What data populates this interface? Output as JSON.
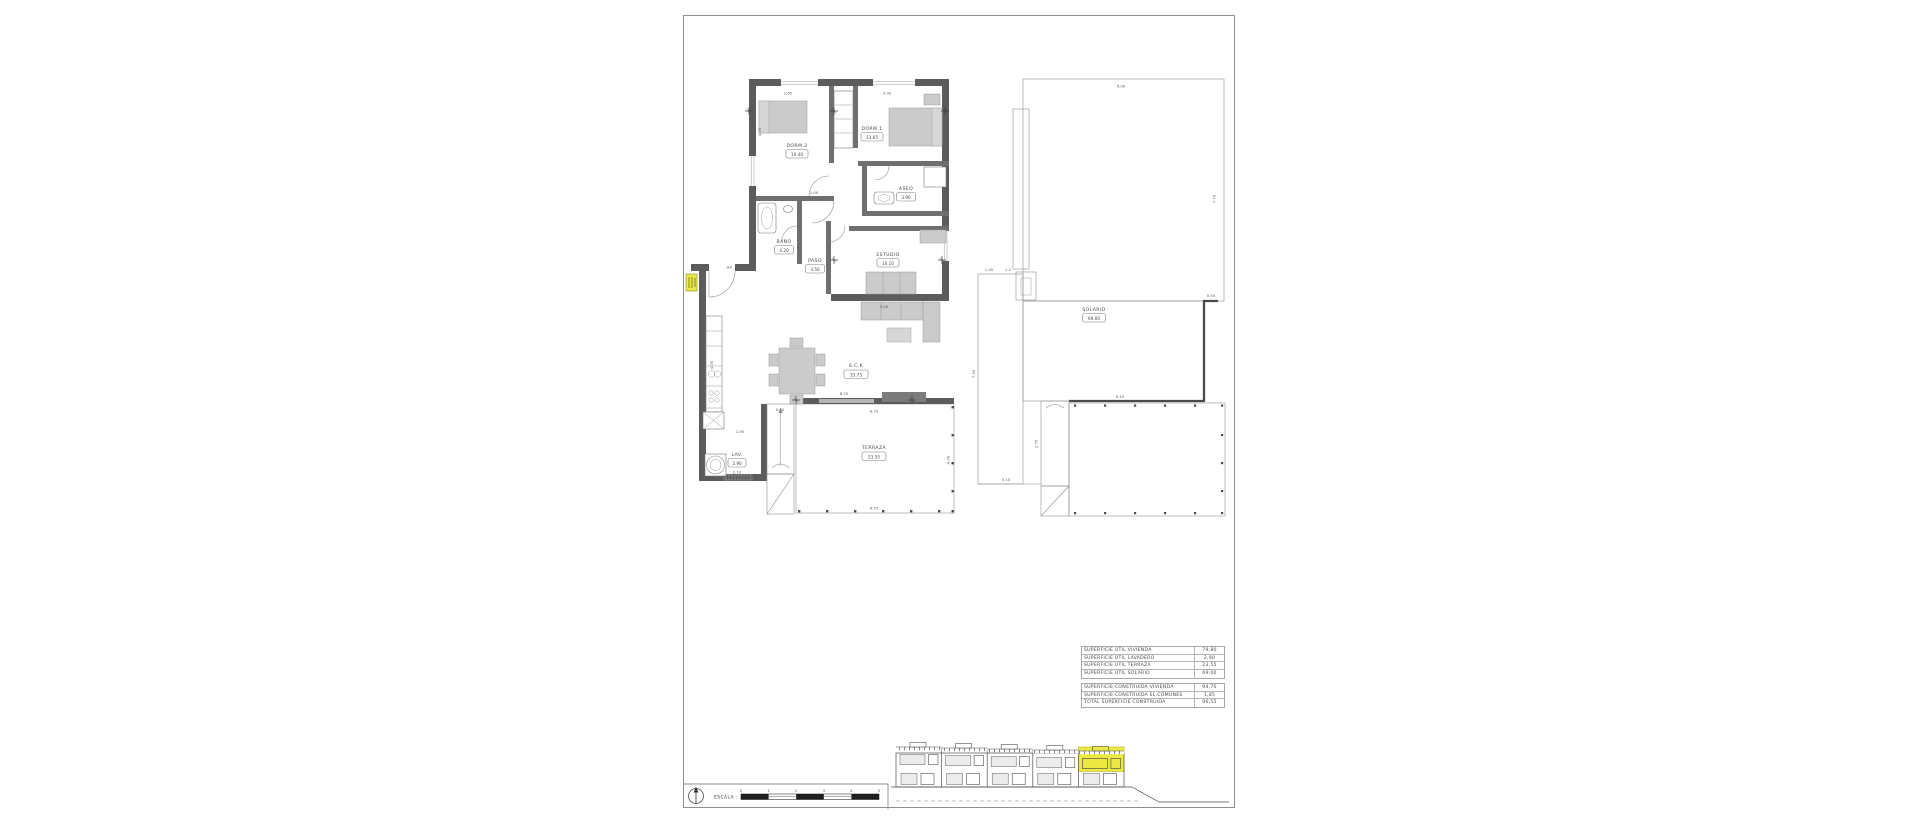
{
  "floor_plan": {
    "rooms": {
      "dorm2": {
        "label": "DORM.2",
        "area": "10.40"
      },
      "dorm1": {
        "label": "DORM.1",
        "area": "13.65"
      },
      "aseo": {
        "label": "ASEO",
        "area": "3.90"
      },
      "bano": {
        "label": "BAÑO",
        "area": "4.20"
      },
      "paso": {
        "label": "PASO",
        "area": "3.50"
      },
      "estudio": {
        "label": "ESTUDIO",
        "area": "10.10"
      },
      "sck": {
        "label": "S.C.K",
        "area": "33.75"
      },
      "lav": {
        "label": "LAV.",
        "area": "2.90"
      },
      "terraza": {
        "label": "TERRAZA",
        "area": "23.55"
      }
    },
    "dims": {
      "top_left": "2.65",
      "top_right": "3.00",
      "dorm2_depth": "4.05",
      "entry_door": ".80",
      "hall_width": "1.00",
      "kitchen_run": "4.05",
      "pantry": "1.95",
      "stairs_top": "0.90",
      "stairs_side": "1.10",
      "lav_below": "2.10",
      "sck_bottom": "6.70",
      "estudio_bottom": "3.05",
      "terraza_top": "8.70",
      "terraza_bottom": "6.75",
      "terraza_right": "4.00"
    }
  },
  "roof_plan": {
    "rooms": {
      "solario": {
        "label": "SOLARIO",
        "area": "69.00"
      }
    },
    "dims": {
      "roof_top": "6.90",
      "roof_right": "7.70",
      "parapet": "0.50",
      "left_height": "7.50",
      "notch_a": "1.40",
      "notch_b": "1.2",
      "bottom_left": "3.10",
      "stairs_height": "2.75",
      "terrace_top": "6.10"
    }
  },
  "tables": {
    "util": {
      "rows": [
        {
          "label": "SUPERFICIE ÚTIL VIVIENDA",
          "value": "79,80"
        },
        {
          "label": "SUPERFICIE ÚTIL LAVADERO",
          "value": "2,90"
        },
        {
          "label": "SUPERFICIE ÚTIL TERRAZA",
          "value": "23,55"
        },
        {
          "label": "SUPERFICIE ÚTIL SOLARIO",
          "value": "69,00"
        }
      ]
    },
    "construida": {
      "rows": [
        {
          "label": "SUPERFICIE CONSTRUIDA VIVIENDA",
          "value": "94,70"
        },
        {
          "label": "SUPERFICIE CONSTRUIDA EL.COMUNES",
          "value": "1,85"
        },
        {
          "label": "TOTAL SUPERFICIE CONSTRUIDA",
          "value": "96,55"
        }
      ]
    }
  },
  "scale_bar": {
    "label": "ESCALA :",
    "ticks": [
      "0",
      "1",
      "2",
      "3",
      "4",
      "5"
    ]
  },
  "colors": {
    "wall": "#5c5c5c",
    "highlight_yellow": "#ece943",
    "furniture": "#cbcbcb"
  }
}
